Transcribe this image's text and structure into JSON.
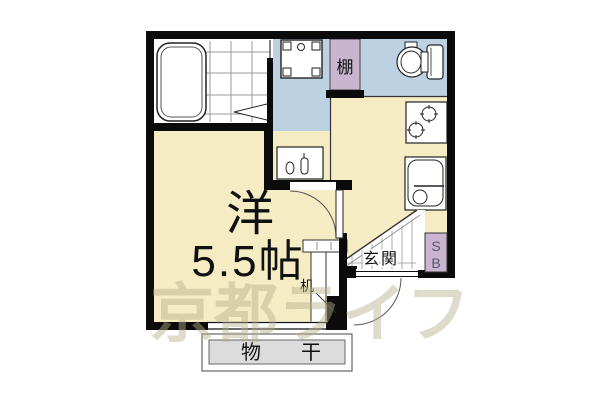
{
  "floorplan": {
    "room": {
      "name": "洋",
      "size": "5.5帖"
    },
    "labels": {
      "shelf": "棚",
      "entrance": "玄関",
      "shoebox_top": "S",
      "shoebox_bottom": "B",
      "desk": "机",
      "drying": "物干"
    },
    "watermark": "京都ライフ",
    "colors": {
      "floor_tan": "#F5ECC4",
      "wet_area_blue": "#BCD2E2",
      "storage_purple": "#C9B5CF",
      "deck_gray": "#DCDCDC",
      "wall_black": "#0b0b0b",
      "watermark_beige": "#b9af8a"
    }
  }
}
